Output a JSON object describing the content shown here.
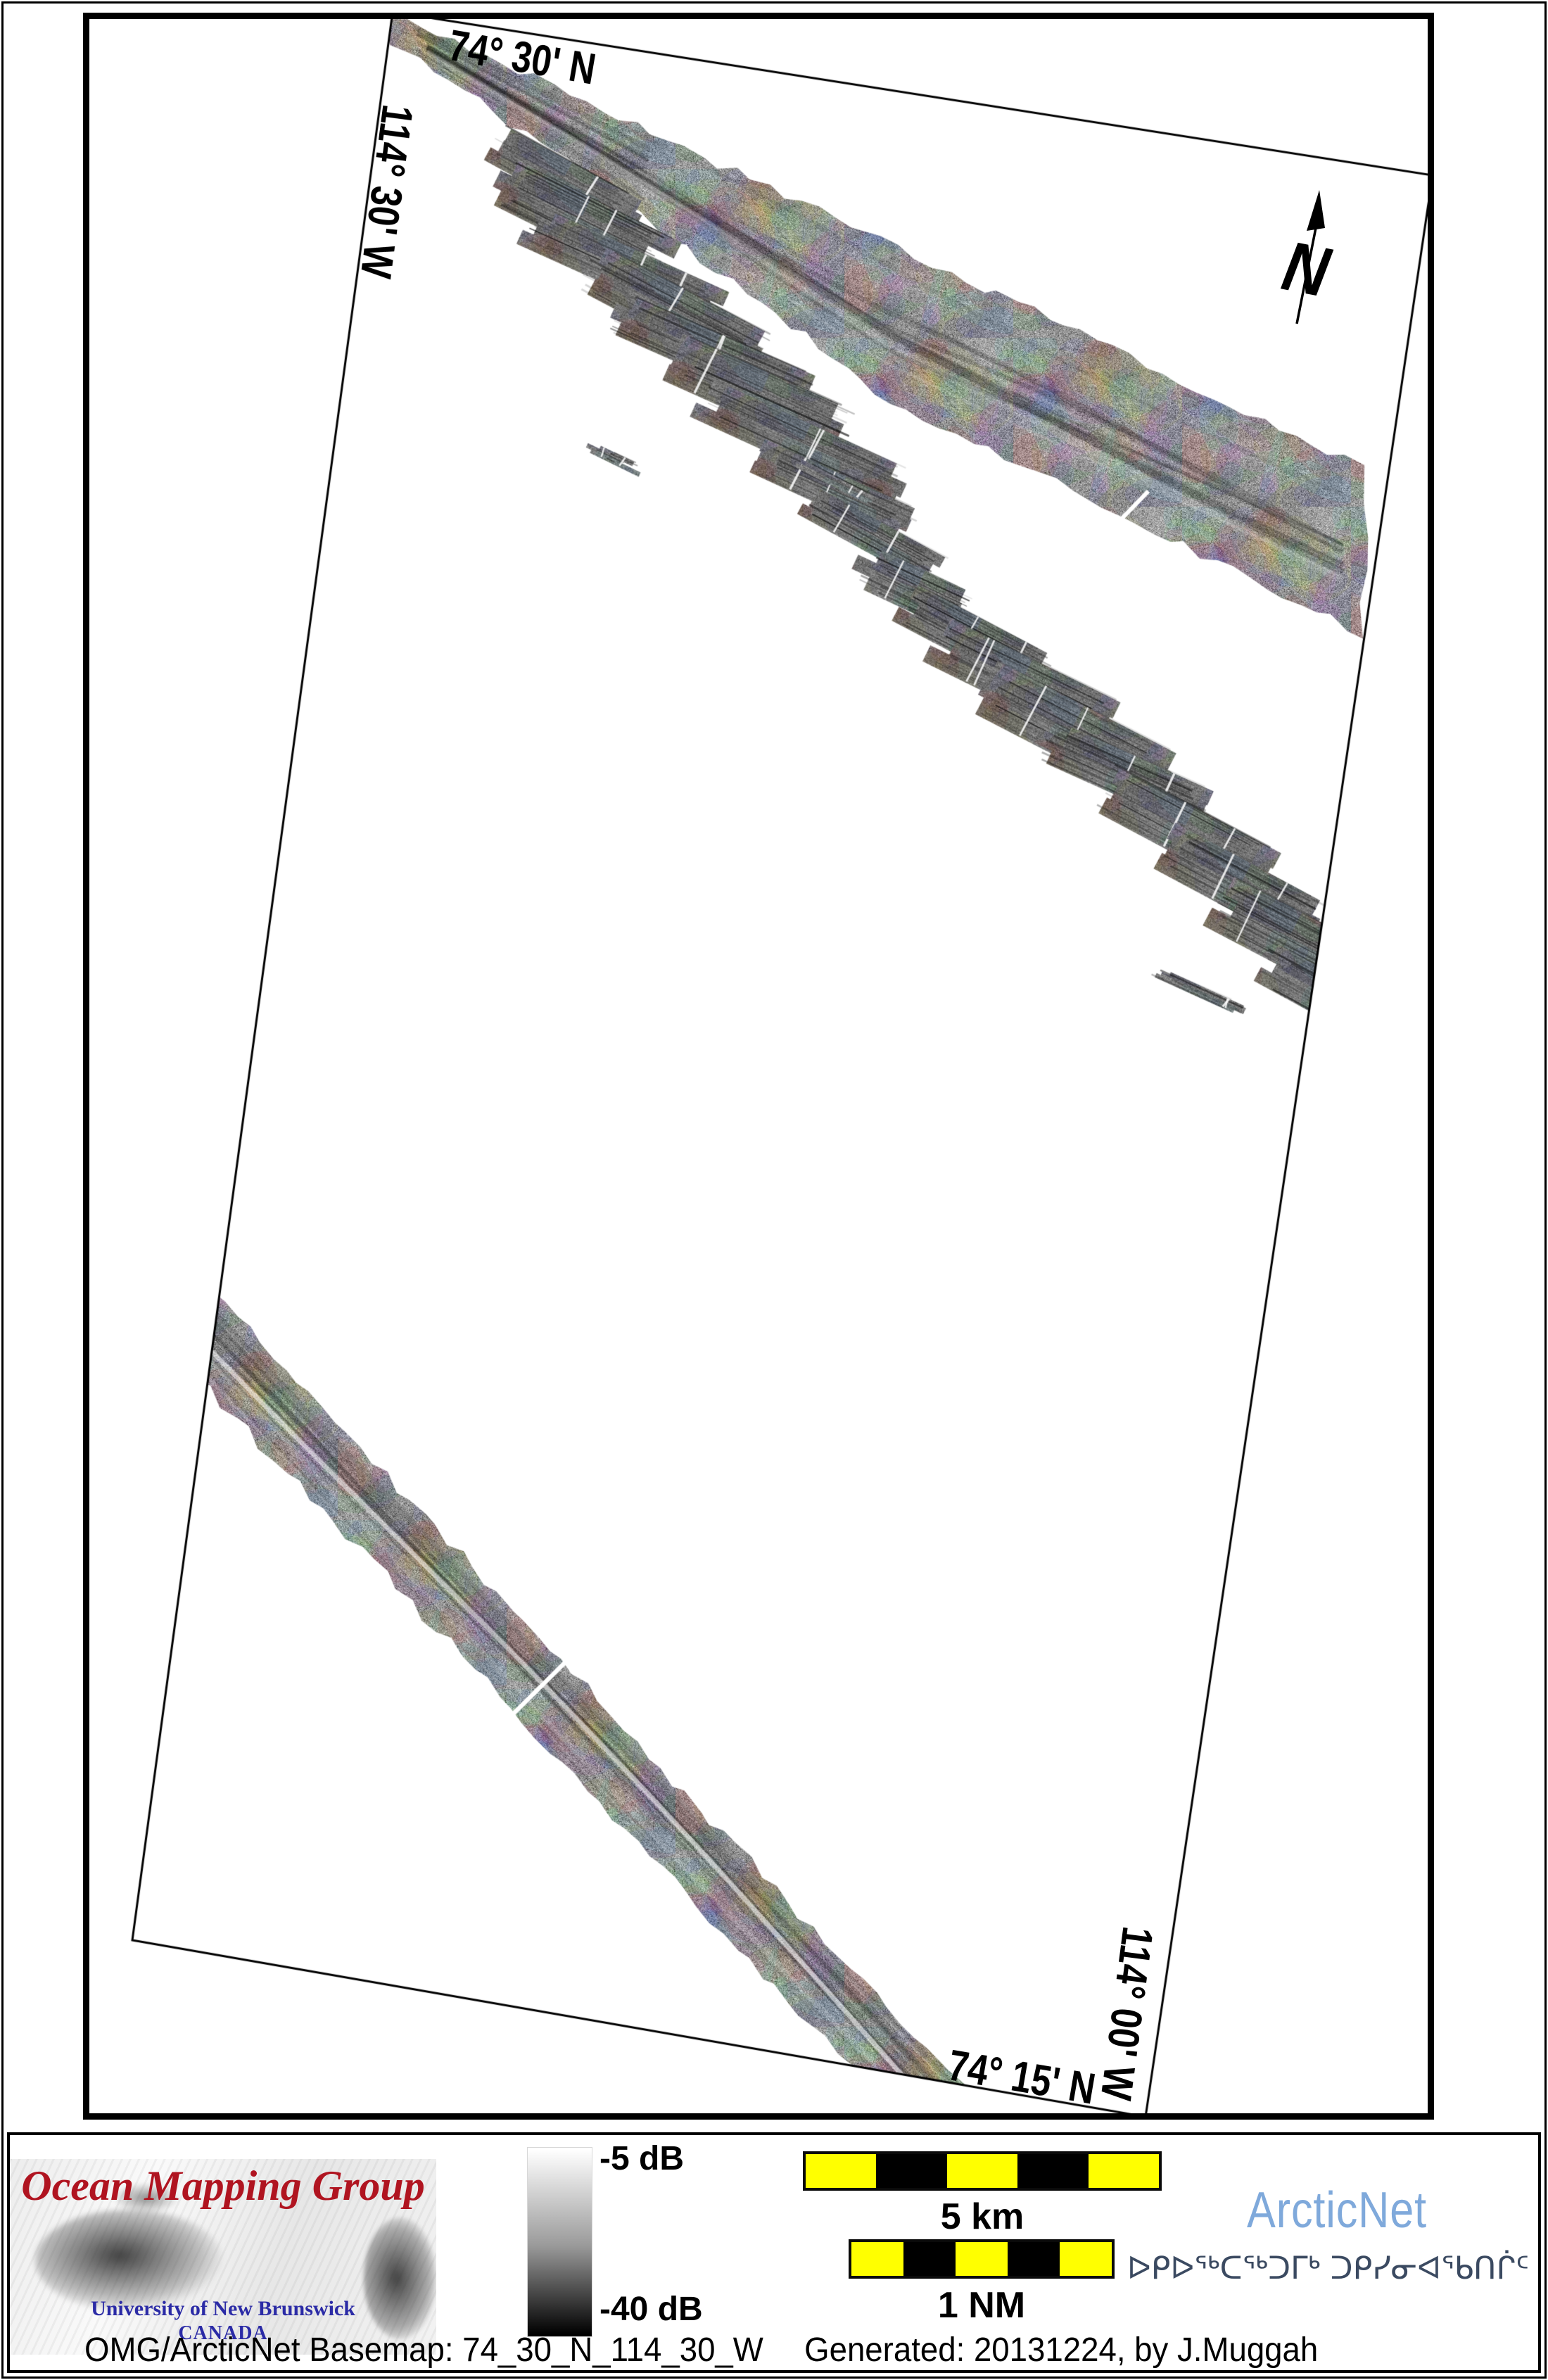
{
  "map": {
    "grid_labels": {
      "top_latitude": "74° 30' N",
      "left_longitude": "114° 30' W",
      "bottom_latitude": "74° 15' N",
      "right_longitude": "114° 00' W"
    },
    "north_arrow_label": "N"
  },
  "legend": {
    "colorbar": {
      "top_label": "-5 dB",
      "bottom_label": "-40 dB",
      "top_color": "#ffffff",
      "bottom_color": "#000000"
    },
    "scalebar_km": {
      "label": "5 km",
      "segments": 5,
      "segment_colors": [
        "#ffff00",
        "#000000",
        "#ffff00",
        "#000000",
        "#ffff00"
      ]
    },
    "scalebar_nm": {
      "label": "1 NM",
      "segments": 5,
      "segment_colors": [
        "#ffff00",
        "#000000",
        "#ffff00",
        "#000000",
        "#ffff00"
      ]
    }
  },
  "logos": {
    "omg": {
      "title": "Ocean Mapping Group",
      "institution": "University of New Brunswick",
      "country": "CANADA",
      "title_color": "#b01420",
      "institution_color": "#2b2ba6"
    },
    "arcticnet": {
      "name": "ArcticNet",
      "inuktitut": "ᐅᑭᐅᖅᑕᖅᑐᒥᒃ ᑐᑭᓯᓂᐊᖃᑎᒌᑦ",
      "name_color": "#7fa9db",
      "inuktitut_color": "#3b4a61"
    }
  },
  "caption": {
    "basemap": "OMG/ArcticNet Basemap: 74_30_N_114_30_W",
    "generated": "Generated: 20131224, by J.Muggah"
  },
  "map_features": {
    "quad_corners": [
      [
        558,
        17
      ],
      [
        2036,
        249
      ],
      [
        1628,
        3008
      ],
      [
        188,
        2757
      ]
    ],
    "base_gray": 152,
    "swaths": [
      {
        "name": "northern-survey-track",
        "top_edge": [
          [
            552,
            12
          ],
          [
            1935,
            662
          ]
        ],
        "bottom_edge": [
          [
            552,
            58
          ],
          [
            852,
            262
          ],
          [
            1252,
            560
          ],
          [
            1938,
            902
          ]
        ],
        "gap": [
          [
            1632,
            698
          ],
          [
            1504,
            830
          ]
        ],
        "extra_dark_start": true,
        "channel": false
      },
      {
        "name": "southern-survey-track",
        "top_edge": [
          [
            138,
            1664
          ],
          [
            1422,
            3022
          ]
        ],
        "bottom_edge": [
          [
            138,
            1806
          ],
          [
            1422,
            3164
          ]
        ],
        "gap": [
          [
            860,
            2306
          ],
          [
            650,
            2514
          ]
        ],
        "extra_dark_start": false,
        "channel": true
      }
    ],
    "patch_angle_deg": 26,
    "patches": [
      [
        800,
        255,
        230,
        55
      ],
      [
        825,
        312,
        260,
        70
      ],
      [
        890,
        382,
        300,
        60
      ],
      [
        958,
        442,
        280,
        70
      ],
      [
        1012,
        502,
        300,
        60
      ],
      [
        1080,
        562,
        280,
        70
      ],
      [
        1140,
        630,
        320,
        60
      ],
      [
        1192,
        700,
        240,
        50
      ],
      [
        1242,
        762,
        220,
        45
      ],
      [
        1302,
        838,
        170,
        60
      ],
      [
        1382,
        906,
        240,
        60
      ],
      [
        1452,
        968,
        280,
        70
      ],
      [
        1522,
        1038,
        300,
        80
      ],
      [
        1602,
        1102,
        260,
        60
      ],
      [
        1682,
        1178,
        260,
        70
      ],
      [
        1762,
        1258,
        240,
        70
      ],
      [
        1832,
        1332,
        230,
        80
      ],
      [
        1882,
        1412,
        200,
        60
      ],
      [
        1195,
        688,
        130,
        12
      ],
      [
        872,
        650,
        85,
        14
      ],
      [
        1705,
        1408,
        145,
        14
      ]
    ]
  }
}
